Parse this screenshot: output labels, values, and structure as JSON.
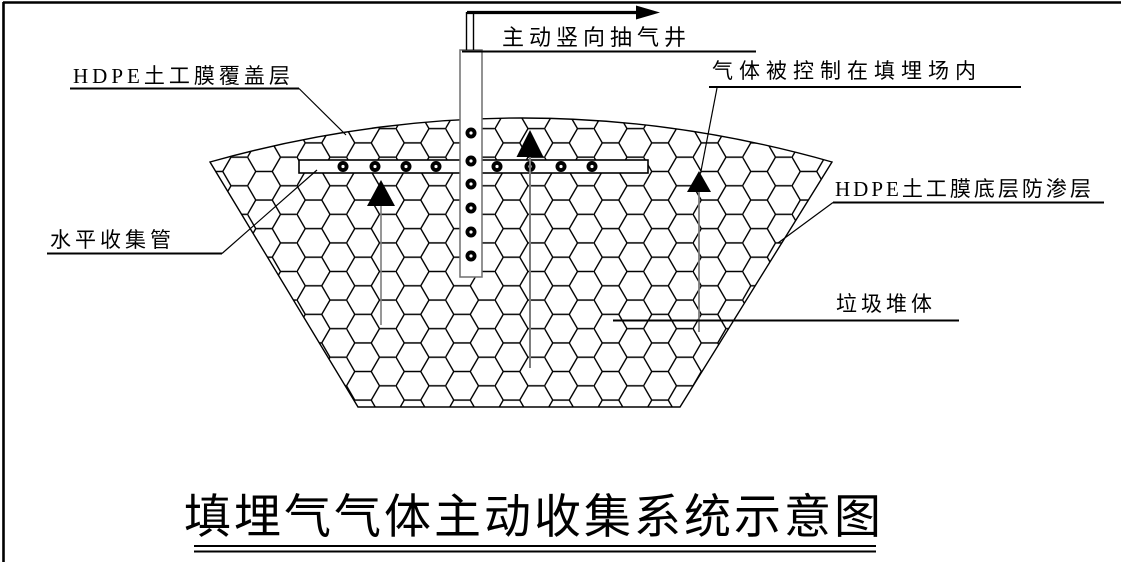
{
  "diagram": {
    "title": "填埋气气体主动收集系统示意图",
    "annotations": {
      "extraction_well": {
        "label": "主动竖向抽气井"
      },
      "hdpe_cover": {
        "label": "HDPE土工膜覆盖层"
      },
      "gas_contained": {
        "label": "气体被控制在填埋场内"
      },
      "hdpe_liner": {
        "label": "HDPE土工膜底层防渗层"
      },
      "horizontal_pipe": {
        "label": "水平收集管"
      },
      "waste_body": {
        "label": "垃圾堆体"
      }
    },
    "icons": {
      "gas_flow_arrow": "up-triangle-arrow",
      "extraction_arrow": "right-arrow"
    },
    "colors": {
      "line": "#000000",
      "gray_stem": "#7d7d7d",
      "casing_gray": "#6e6e6e",
      "background": "#ffffff"
    }
  }
}
